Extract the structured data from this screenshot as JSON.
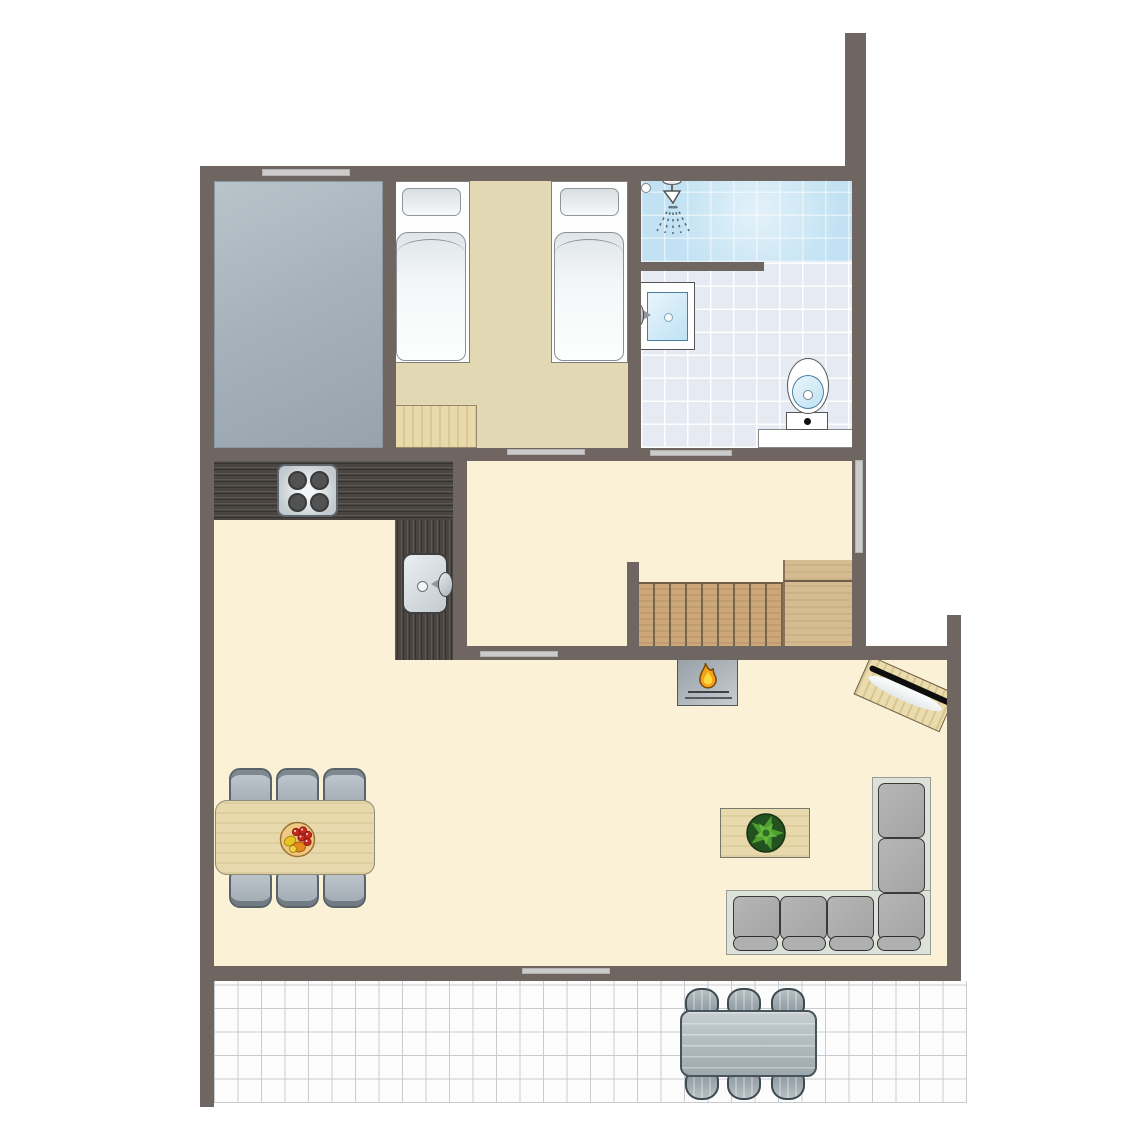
{
  "meta": {
    "type": "floor-plan",
    "description": "Top-down floor plan of a holiday home with bedroom, bathroom, kitchen, living room, staircase and tiled terrace",
    "visible_text": "none"
  },
  "palette": {
    "background": "#FFFFFF",
    "wall": "#6F6661",
    "door_window_bar": "#CBCBCB",
    "floor_cream": "#FBF1D6",
    "floor_bedroom_tan": "#E2D8B4",
    "floor_gray_room": "#A7B2BB",
    "bathroom_tile": "#E6EBF3",
    "shower_blue": "#C2E2F3",
    "terrace_tile": "#FCFCFD",
    "terrace_grid": "#C8CCD0",
    "counter_dark_wood": "#4A4541",
    "stair_wood": "#CBA77A",
    "stair_landing_wood": "#D6BA90",
    "light_wood": "#E9DAAB",
    "sofa_base": "#DCE1D9",
    "sofa_cushion": "#AFAFAF",
    "chair_gray": "#A7B1B9",
    "flame_orange": "#F5A11C",
    "flame_yellow": "#FFD83B",
    "plant_green": "#4E9F2F",
    "basin_blue": "#C7E5F6"
  },
  "rooms": [
    {
      "id": "gray-room",
      "label": "unfurnished gray room",
      "features": [
        "window in top wall"
      ]
    },
    {
      "id": "bedroom",
      "label": "twin bedroom",
      "furniture": [
        "single bed",
        "single bed",
        "wooden cabinet"
      ],
      "openings": [
        "door to hallway"
      ]
    },
    {
      "id": "bathroom",
      "label": "bathroom",
      "furniture": [
        "shower with ceiling head",
        "washbasin",
        "toilet"
      ],
      "openings": [
        "door to hallway"
      ]
    },
    {
      "id": "hallway",
      "label": "hallway",
      "furniture": [
        "staircase with landing"
      ],
      "openings": [
        "window in right wall",
        "opening to living room"
      ]
    },
    {
      "id": "kitchen",
      "label": "open kitchen",
      "furniture": [
        "L-shaped dark wood counter",
        "4-burner stove",
        "kitchen sink with faucet"
      ]
    },
    {
      "id": "living-room",
      "label": "living room",
      "furniture": [
        "fireplace",
        "TV on corner cabinet",
        "dining table with 6 chairs",
        "fruit bowl",
        "coffee table with plant",
        "L-shaped corner sofa"
      ],
      "openings": [
        "door to terrace"
      ]
    },
    {
      "id": "terrace",
      "label": "tiled terrace",
      "furniture": [
        "garden table with 6 chairs"
      ]
    }
  ],
  "openings": [
    {
      "id": "window-top",
      "kind": "window",
      "wall": "top"
    },
    {
      "id": "door-bedroom",
      "kind": "door-opening",
      "wall": "bedroom-hallway"
    },
    {
      "id": "door-bathroom",
      "kind": "door-opening",
      "wall": "bathroom-hallway"
    },
    {
      "id": "window-right",
      "kind": "window",
      "wall": "right"
    },
    {
      "id": "door-hall-living",
      "kind": "door-opening",
      "wall": "hallway-living"
    },
    {
      "id": "door-terrace",
      "kind": "door-opening",
      "wall": "living-terrace"
    }
  ],
  "icons": [
    {
      "id": "shower-head-icon",
      "meaning": "shower spray"
    },
    {
      "id": "flame-icon",
      "meaning": "fireplace"
    },
    {
      "id": "plant-icon",
      "meaning": "potted plant on coffee table"
    },
    {
      "id": "fruit-bowl-icon",
      "meaning": "fruit bowl on dining table"
    }
  ]
}
